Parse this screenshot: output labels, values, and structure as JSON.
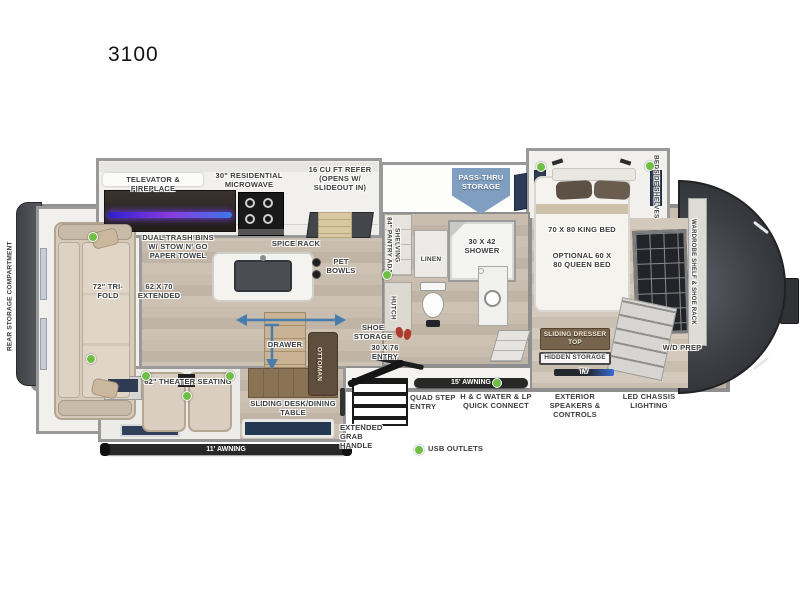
{
  "title": "3100",
  "legend": {
    "usb_outlets": "USB OUTLETS"
  },
  "colors": {
    "usb_dot": "#6fbf44",
    "pass_thru_arrow": "#7f9ec0",
    "awning_bar": "#282828",
    "tv_accent": "#3a6bd6",
    "fireplace_glow": "#8a3be0"
  },
  "exterior": {
    "rear_storage_compartment": "REAR STORAGE COMPARTMENT",
    "pass_thru_storage": "PASS-THRU STORAGE",
    "awning_15": "15' AWNING",
    "awning_11": "11' AWNING",
    "quad_step_entry": "QUAD STEP ENTRY",
    "water_lp": "H & C WATER & LP QUICK CONNECT",
    "exterior_speakers": "EXTERIOR SPEAKERS & CONTROLS",
    "led_chassis": "LED CHASSIS LIGHTING",
    "extended_grab_handle": "EXTENDED GRAB HANDLE",
    "entry_door": "30 x 76 ENTRY"
  },
  "kitchen": {
    "televator_fireplace": "TELEVATOR & FIREPLACE",
    "residential_microwave": "30\" RESIDENTIAL MICROWAVE",
    "refer": "16 CU FT REFER (OPENS W/ SLIDEOUT IN)",
    "dual_trash_bins": "DUAL TRASH BINS W/ STOW N' GO PAPER TOWEL",
    "spice_rack": "SPICE RACK",
    "pet_bowls": "PET BOWLS"
  },
  "living": {
    "tri_fold_sofa": "72\" TRI-FOLD",
    "sofa_extended": "62 x 70 EXTENDED",
    "theater_seating": "62\" THEATER SEATING",
    "sliding_desk": "SLIDING DESK/DINING TABLE",
    "drawer": "DRAWER",
    "ottoman": "OTTOMAN",
    "hutch": "HUTCH",
    "shoe_storage": "SHOE STORAGE"
  },
  "bathroom": {
    "pantry": "84\" PANTRY ADJ SHELVING",
    "linen": "LINEN",
    "shower": "30 x 42 SHOWER"
  },
  "bedroom": {
    "king_bed": "70 x 80 KING BED",
    "queen_option": "OPTIONAL 60 x 80 QUEEN BED",
    "bedside_shelves": "BEDSIDE SHELVES",
    "wardrobe": "WARDROBE SHELF & SHOE RACK",
    "sliding_dresser_top": "SLIDING DRESSER TOP",
    "hidden_storage": "HIDDEN STORAGE",
    "tv": "TV",
    "wd_prep": "W/D PREP"
  }
}
